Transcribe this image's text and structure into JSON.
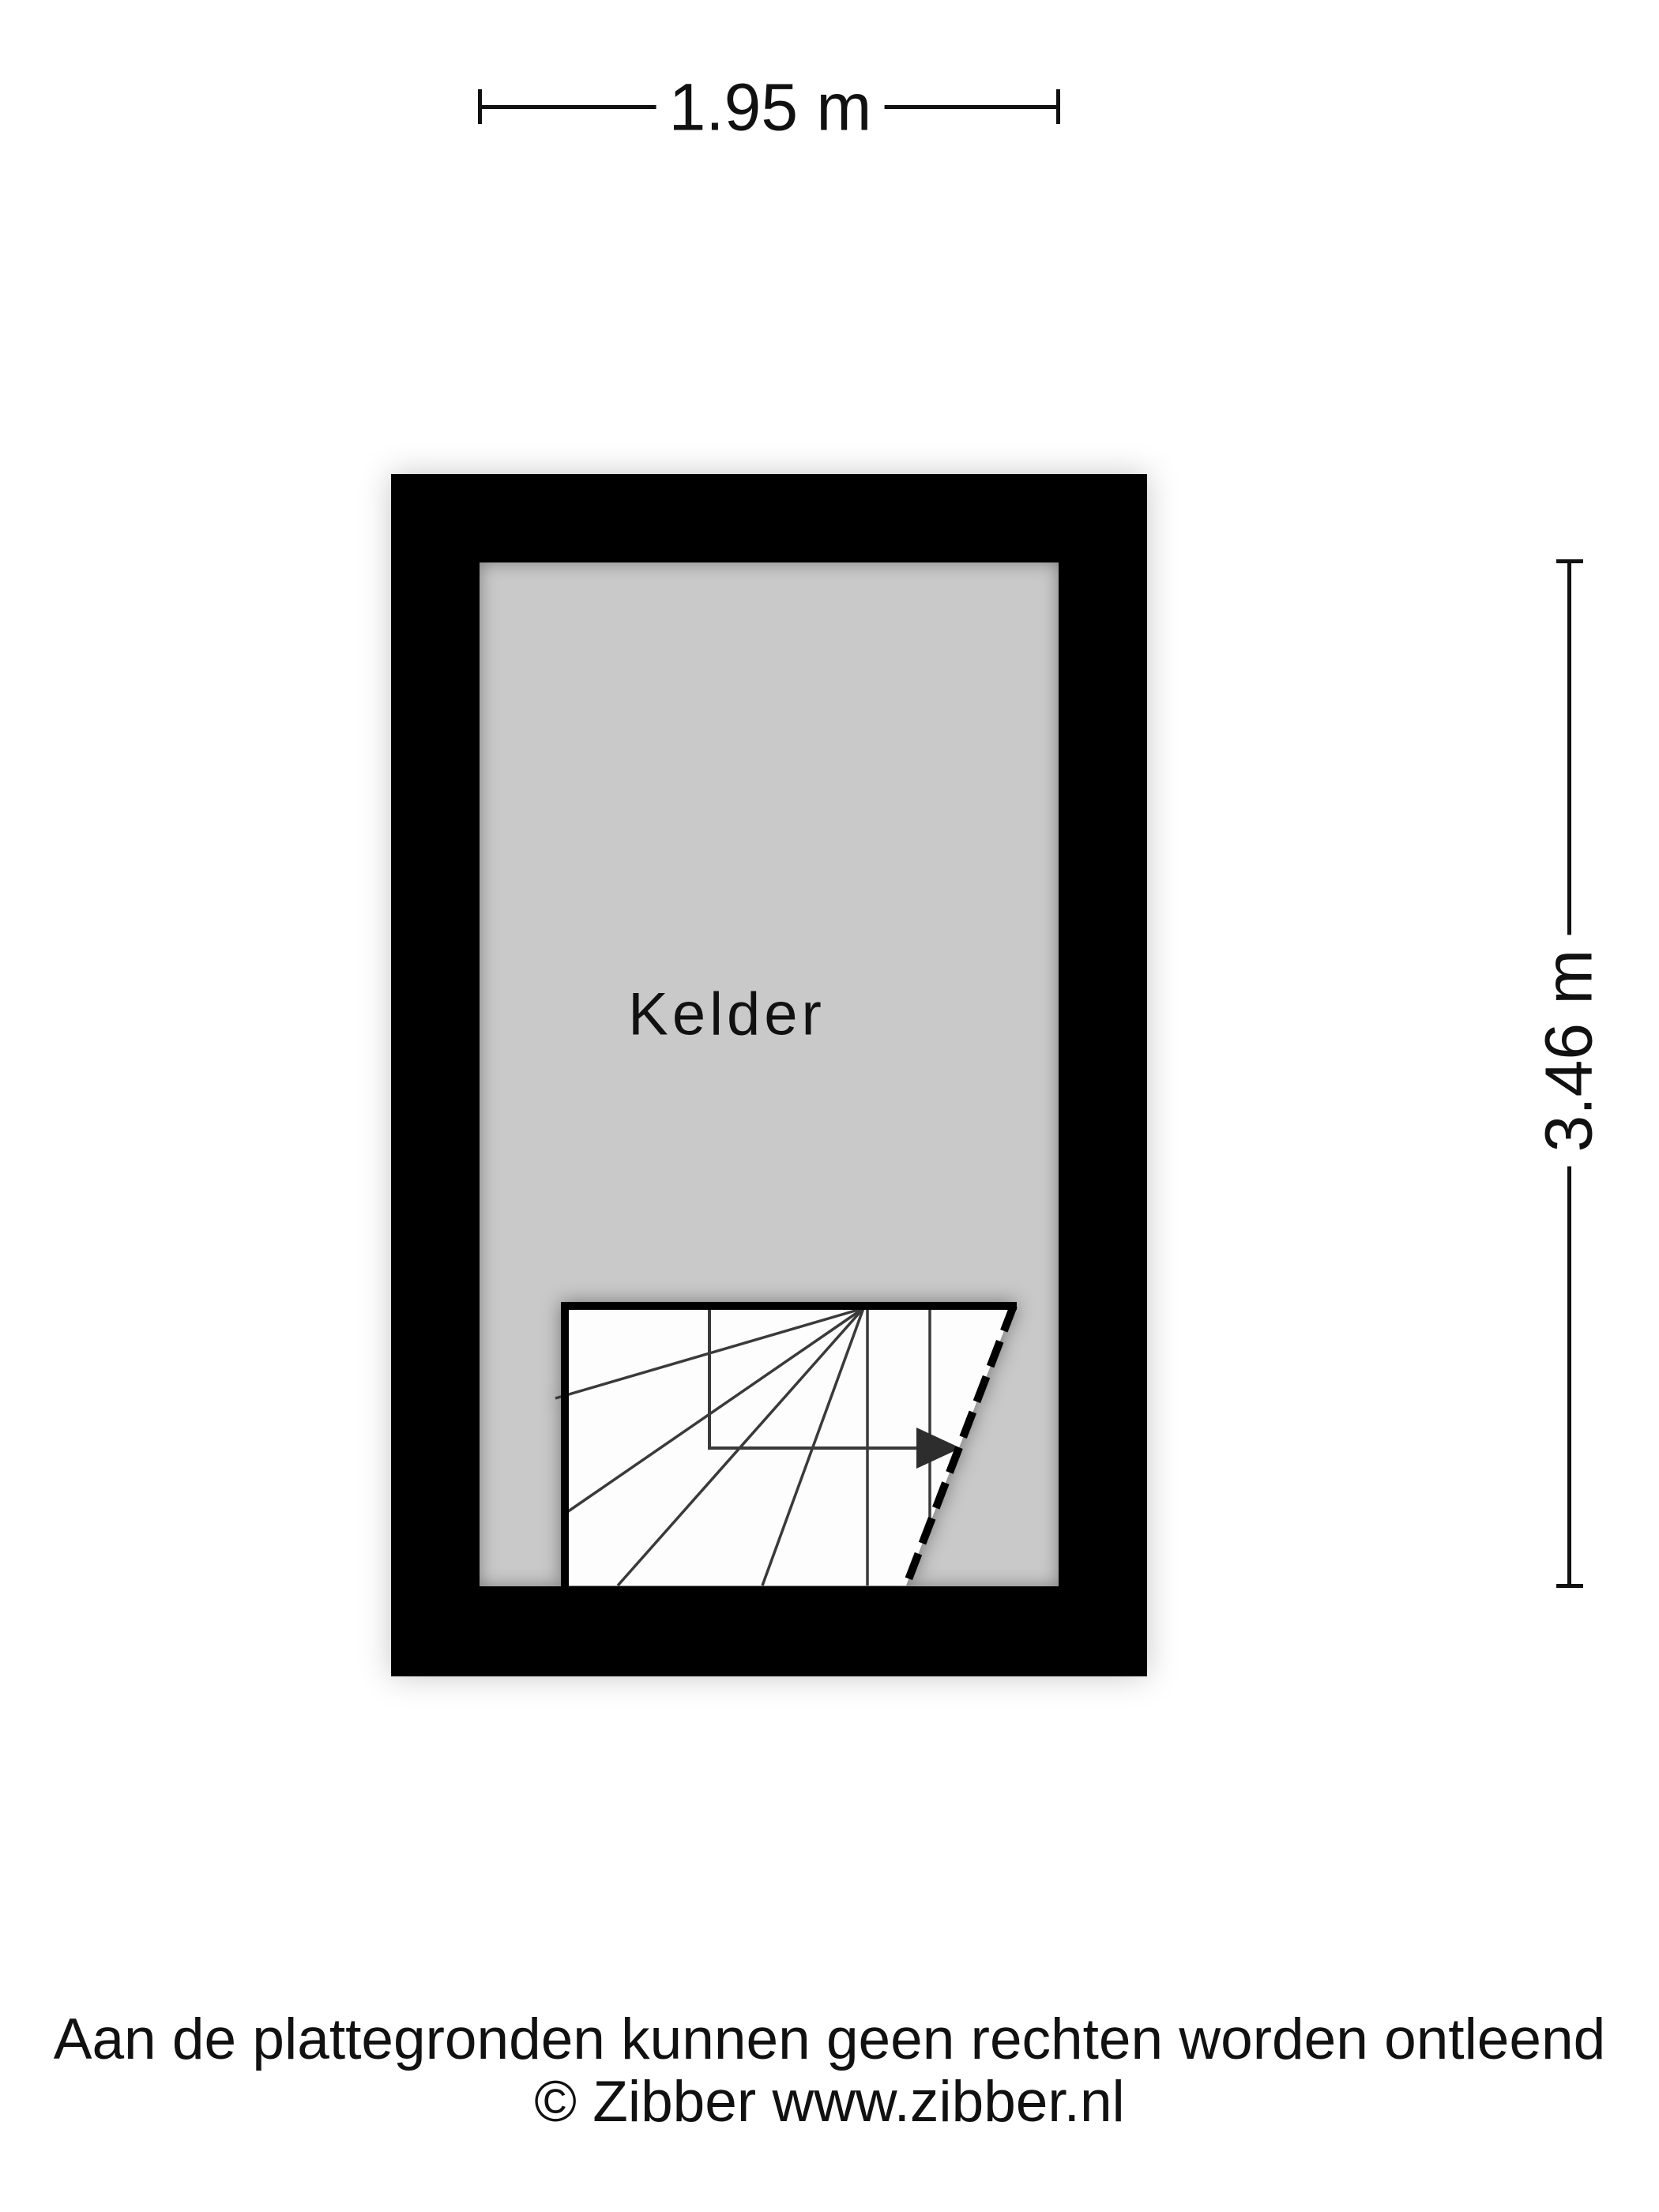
{
  "dimensions": {
    "width_label": "1.95 m",
    "height_label": "3.46 m"
  },
  "room": {
    "label": "Kelder"
  },
  "footer": {
    "line1": "Aan de plattegronden kunnen geen rechten worden ontleend",
    "line2": "© Zibber www.zibber.nl"
  },
  "colors": {
    "bg": "#ffffff",
    "wall": "#000000",
    "floor": "#c9c9c9",
    "stair": "#fdfdfd",
    "line": "#3a3a3a",
    "text": "#111111"
  }
}
